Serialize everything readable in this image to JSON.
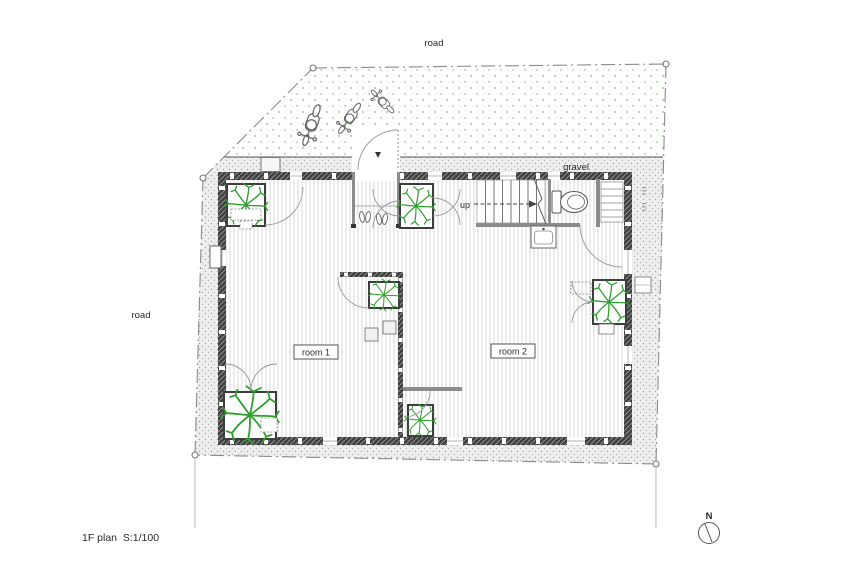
{
  "plan": {
    "title": "1F plan  S:1/100",
    "labels": {
      "road_top": "road",
      "road_left": "road",
      "gravel": "gravel",
      "up": "up",
      "room1": "room 1",
      "room2": "room 2",
      "north": "N"
    },
    "colors": {
      "tree": "#2f9e2f",
      "wall": "#404040",
      "partition": "#8c8c8c",
      "floor_line": "#cfcfcf",
      "gravel_dot": "#a3a3a3",
      "grass_dot": "#b7d9b7",
      "boundary": "#8a8a8a",
      "line": "#555555"
    }
  }
}
